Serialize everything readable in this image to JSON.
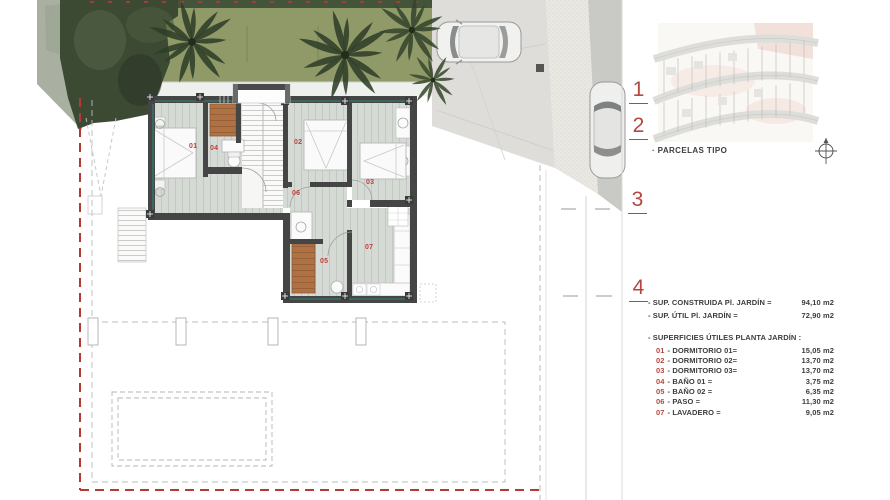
{
  "panel": {
    "index_labels": [
      "1",
      "2",
      "3",
      "4"
    ],
    "parcelas_caption": "· PARCELAS TIPO",
    "summary": [
      {
        "label": "- SUP. CONSTRUIDA Pl. JARDÍN =",
        "value": "94,10 m2"
      },
      {
        "label": "- SUP. ÚTIL Pl. JARDÍN =",
        "value": "72,90 m2"
      }
    ],
    "surfaces_heading": "- SUPERFICIES ÚTILES PLANTA JARDÍN :",
    "rooms": [
      {
        "num": "01",
        "label": "- DORMITORIO 01=",
        "value": "15,05 m2"
      },
      {
        "num": "02",
        "label": "- DORMITORIO 02=",
        "value": "13,70 m2"
      },
      {
        "num": "03",
        "label": "- DORMITORIO 03=",
        "value": "13,70 m2"
      },
      {
        "num": "04",
        "label": "- BAÑO 01 =",
        "value": "3,75 m2"
      },
      {
        "num": "05",
        "label": "- BAÑO 02 =",
        "value": "6,35 m2"
      },
      {
        "num": "06",
        "label": "- PASO =",
        "value": "11,30 m2"
      },
      {
        "num": "07",
        "label": "- LAVADERO =",
        "value": "9,05 m2"
      }
    ]
  },
  "plan": {
    "room_labels": [
      "01",
      "02",
      "03",
      "04",
      "05",
      "06",
      "07"
    ]
  },
  "colors": {
    "accent_red": "#b5473f",
    "wall": "#454545",
    "floor": "#d6dad5",
    "garden_green": "#8d9768",
    "tree_green": "#2f3e28",
    "terracotta": "#b17243",
    "road_gray": "#c9c9c6",
    "window_teal": "#2f8d7d"
  }
}
